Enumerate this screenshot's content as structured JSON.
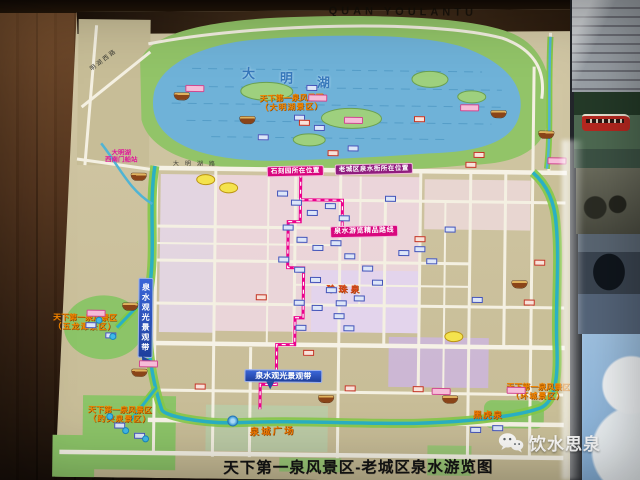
{
  "banner": {
    "pinyin": "QUAN  YOULANTU"
  },
  "title": {
    "text": "天下第一泉风景区-老城区泉水游览图"
  },
  "watermark": {
    "label": "饮水思泉",
    "icon": "wechat-icon"
  },
  "lake": {
    "char1": "大",
    "char2": "明",
    "char3": "湖"
  },
  "scenic": [
    {
      "l1": "天下第一泉风景区",
      "l2": "（大明湖景区）"
    },
    {
      "l1": "天下第一泉风景区",
      "l2": "（五龙潭景区）"
    },
    {
      "l1": "天下第一泉风景区",
      "l2": "（趵突泉景区）"
    },
    {
      "l1": "天下第一泉风景区",
      "l2": "（环城景区）"
    }
  ],
  "springs": {
    "zhenzhu": "珍珠泉",
    "heihu": "黑虎泉"
  },
  "plaza": {
    "label": "泉城广场"
  },
  "ribbons": {
    "location_left": "石刻园所在位置",
    "location_right": "老城区泉水街所在位置",
    "route": "泉水游览精品路线"
  },
  "belt": {
    "label": "泉水观光景观带"
  },
  "roads": {
    "minghu_west": "明湖西路",
    "daminghu": "大明湖路"
  },
  "station": {
    "l1": "大明湖",
    "l2": "西南门船站"
  },
  "colors": {
    "paper": "#cdc3a0",
    "water": "#6fb2d8",
    "park": "#92c468",
    "moat": "#2ab0c4",
    "scenic_orange": "#f28500",
    "route_magenta": "#ec008c",
    "belt_blue": "#2b52c0",
    "ribbon_magenta": "#d8077e",
    "wood": "#4a2d18"
  },
  "markers": [
    {
      "x": 180,
      "y": 98,
      "t": "b"
    },
    {
      "x": 246,
      "y": 121,
      "t": "b"
    },
    {
      "x": 138,
      "y": 179,
      "t": "b"
    },
    {
      "x": 497,
      "y": 112,
      "t": "b"
    },
    {
      "x": 545,
      "y": 132,
      "t": "b"
    },
    {
      "x": 131,
      "y": 309,
      "t": "b"
    },
    {
      "x": 141,
      "y": 375,
      "t": "b"
    },
    {
      "x": 328,
      "y": 399,
      "t": "b"
    },
    {
      "x": 452,
      "y": 398,
      "t": "b"
    },
    {
      "x": 520,
      "y": 282,
      "t": "b"
    },
    {
      "x": 193,
      "y": 90,
      "t": "pc"
    },
    {
      "x": 316,
      "y": 98,
      "t": "pc"
    },
    {
      "x": 468,
      "y": 106,
      "t": "pc"
    },
    {
      "x": 97,
      "y": 316,
      "t": "pc"
    },
    {
      "x": 150,
      "y": 366,
      "t": "pc"
    },
    {
      "x": 443,
      "y": 390,
      "t": "pc"
    },
    {
      "x": 518,
      "y": 388,
      "t": "pc"
    },
    {
      "x": 556,
      "y": 158,
      "t": "pc"
    },
    {
      "x": 352,
      "y": 120,
      "t": "pc"
    },
    {
      "x": 298,
      "y": 118,
      "t": "bc"
    },
    {
      "x": 318,
      "y": 128,
      "t": "bc"
    },
    {
      "x": 282,
      "y": 194,
      "t": "bc"
    },
    {
      "x": 296,
      "y": 203,
      "t": "bc"
    },
    {
      "x": 312,
      "y": 213,
      "t": "bc"
    },
    {
      "x": 330,
      "y": 206,
      "t": "bc"
    },
    {
      "x": 344,
      "y": 218,
      "t": "bc"
    },
    {
      "x": 288,
      "y": 228,
      "t": "bc"
    },
    {
      "x": 302,
      "y": 240,
      "t": "bc"
    },
    {
      "x": 318,
      "y": 248,
      "t": "bc"
    },
    {
      "x": 336,
      "y": 243,
      "t": "bc"
    },
    {
      "x": 350,
      "y": 256,
      "t": "bc"
    },
    {
      "x": 284,
      "y": 260,
      "t": "bc"
    },
    {
      "x": 300,
      "y": 270,
      "t": "bc"
    },
    {
      "x": 316,
      "y": 280,
      "t": "bc"
    },
    {
      "x": 332,
      "y": 290,
      "t": "bc"
    },
    {
      "x": 300,
      "y": 303,
      "t": "bc"
    },
    {
      "x": 318,
      "y": 308,
      "t": "bc"
    },
    {
      "x": 342,
      "y": 303,
      "t": "bc"
    },
    {
      "x": 360,
      "y": 298,
      "t": "bc"
    },
    {
      "x": 420,
      "y": 248,
      "t": "bc"
    },
    {
      "x": 432,
      "y": 260,
      "t": "bc"
    },
    {
      "x": 302,
      "y": 328,
      "t": "bc"
    },
    {
      "x": 350,
      "y": 328,
      "t": "bc"
    },
    {
      "x": 478,
      "y": 298,
      "t": "bc"
    },
    {
      "x": 92,
      "y": 328,
      "t": "bc"
    },
    {
      "x": 112,
      "y": 338,
      "t": "bc"
    },
    {
      "x": 122,
      "y": 428,
      "t": "bc"
    },
    {
      "x": 142,
      "y": 438,
      "t": "bc"
    },
    {
      "x": 478,
      "y": 428,
      "t": "bc"
    },
    {
      "x": 500,
      "y": 426,
      "t": "bc"
    },
    {
      "x": 310,
      "y": 88,
      "t": "bc"
    },
    {
      "x": 262,
      "y": 138,
      "t": "bc"
    },
    {
      "x": 352,
      "y": 148,
      "t": "bc"
    },
    {
      "x": 390,
      "y": 198,
      "t": "bc"
    },
    {
      "x": 450,
      "y": 228,
      "t": "bc"
    },
    {
      "x": 368,
      "y": 268,
      "t": "bc"
    },
    {
      "x": 378,
      "y": 282,
      "t": "bc"
    },
    {
      "x": 404,
      "y": 252,
      "t": "bc"
    },
    {
      "x": 340,
      "y": 316,
      "t": "bc"
    },
    {
      "x": 303,
      "y": 123,
      "t": "rc"
    },
    {
      "x": 418,
      "y": 118,
      "t": "rc"
    },
    {
      "x": 332,
      "y": 153,
      "t": "rc"
    },
    {
      "x": 470,
      "y": 163,
      "t": "rc"
    },
    {
      "x": 420,
      "y": 238,
      "t": "rc"
    },
    {
      "x": 262,
      "y": 298,
      "t": "rc"
    },
    {
      "x": 310,
      "y": 353,
      "t": "rc"
    },
    {
      "x": 202,
      "y": 388,
      "t": "rc"
    },
    {
      "x": 420,
      "y": 388,
      "t": "rc"
    },
    {
      "x": 478,
      "y": 153,
      "t": "rc"
    },
    {
      "x": 352,
      "y": 388,
      "t": "rc"
    },
    {
      "x": 530,
      "y": 300,
      "t": "rc"
    },
    {
      "x": 540,
      "y": 260,
      "t": "rc"
    },
    {
      "x": 205,
      "y": 181,
      "t": "yo"
    },
    {
      "x": 455,
      "y": 335,
      "t": "yo"
    },
    {
      "x": 228,
      "y": 189,
      "t": "yo"
    },
    {
      "x": 100,
      "y": 323,
      "t": "sp"
    },
    {
      "x": 114,
      "y": 339,
      "t": "sp"
    },
    {
      "x": 128,
      "y": 433,
      "t": "sp"
    },
    {
      "x": 148,
      "y": 441,
      "t": "sp"
    },
    {
      "x": 112,
      "y": 419,
      "t": "sp"
    },
    {
      "x": 235,
      "y": 422,
      "t": "fc"
    }
  ]
}
